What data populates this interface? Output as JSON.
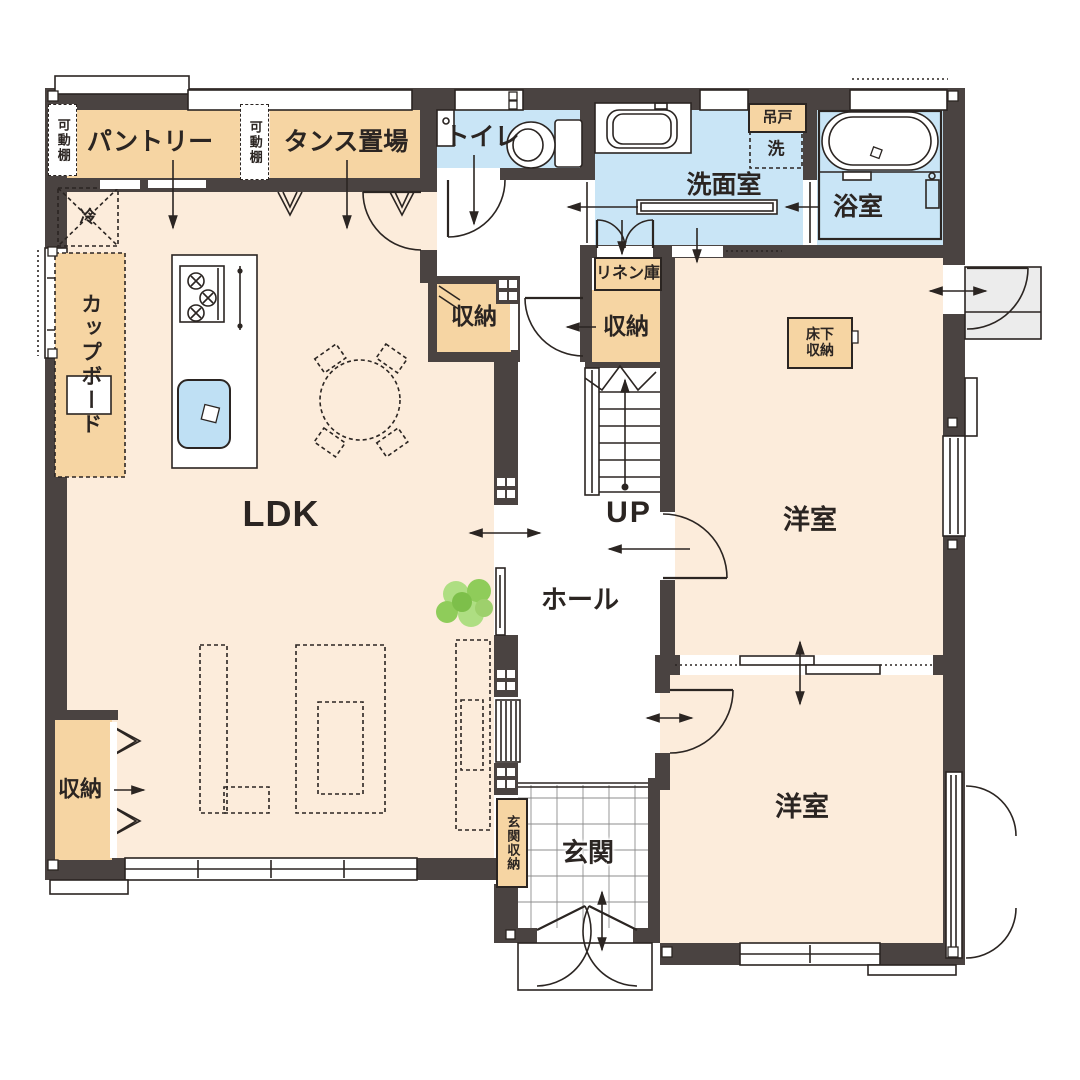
{
  "plan": {
    "rooms": {
      "pantry": "パントリー",
      "tansu": "タンス置場",
      "toilet": "トイレ",
      "washroom": "洗面室",
      "bathroom": "浴室",
      "bedroom_top": "洋室",
      "bedroom_bottom": "洋室",
      "ldk": "LDK",
      "hall": "ホール",
      "entrance": "玄関",
      "stairs_up": "UP"
    },
    "storage": {
      "movable_shelf_left": "可動棚",
      "movable_shelf_mid": "可動棚",
      "cupboard": "カップボード",
      "refrigerator": "冷",
      "washer": "洗",
      "hanging_cupboard": "吊戸",
      "linen": "リネン庫",
      "closet_by_stairs": "収納",
      "closet_corridor": "収納",
      "closet_ldk": "収納",
      "underfloor_storage": "床下収納",
      "entrance_storage": "玄関収納"
    },
    "colors": {
      "wall": "#4a4341",
      "line": "#2b2522",
      "floor": "#fcecdb",
      "wet_floor": "#c9e5f6",
      "storage_fill": "#f6d5a3",
      "water_fill": "#bfe0f4",
      "porch": "#ececec",
      "plant_green": "#9ed06c"
    }
  }
}
